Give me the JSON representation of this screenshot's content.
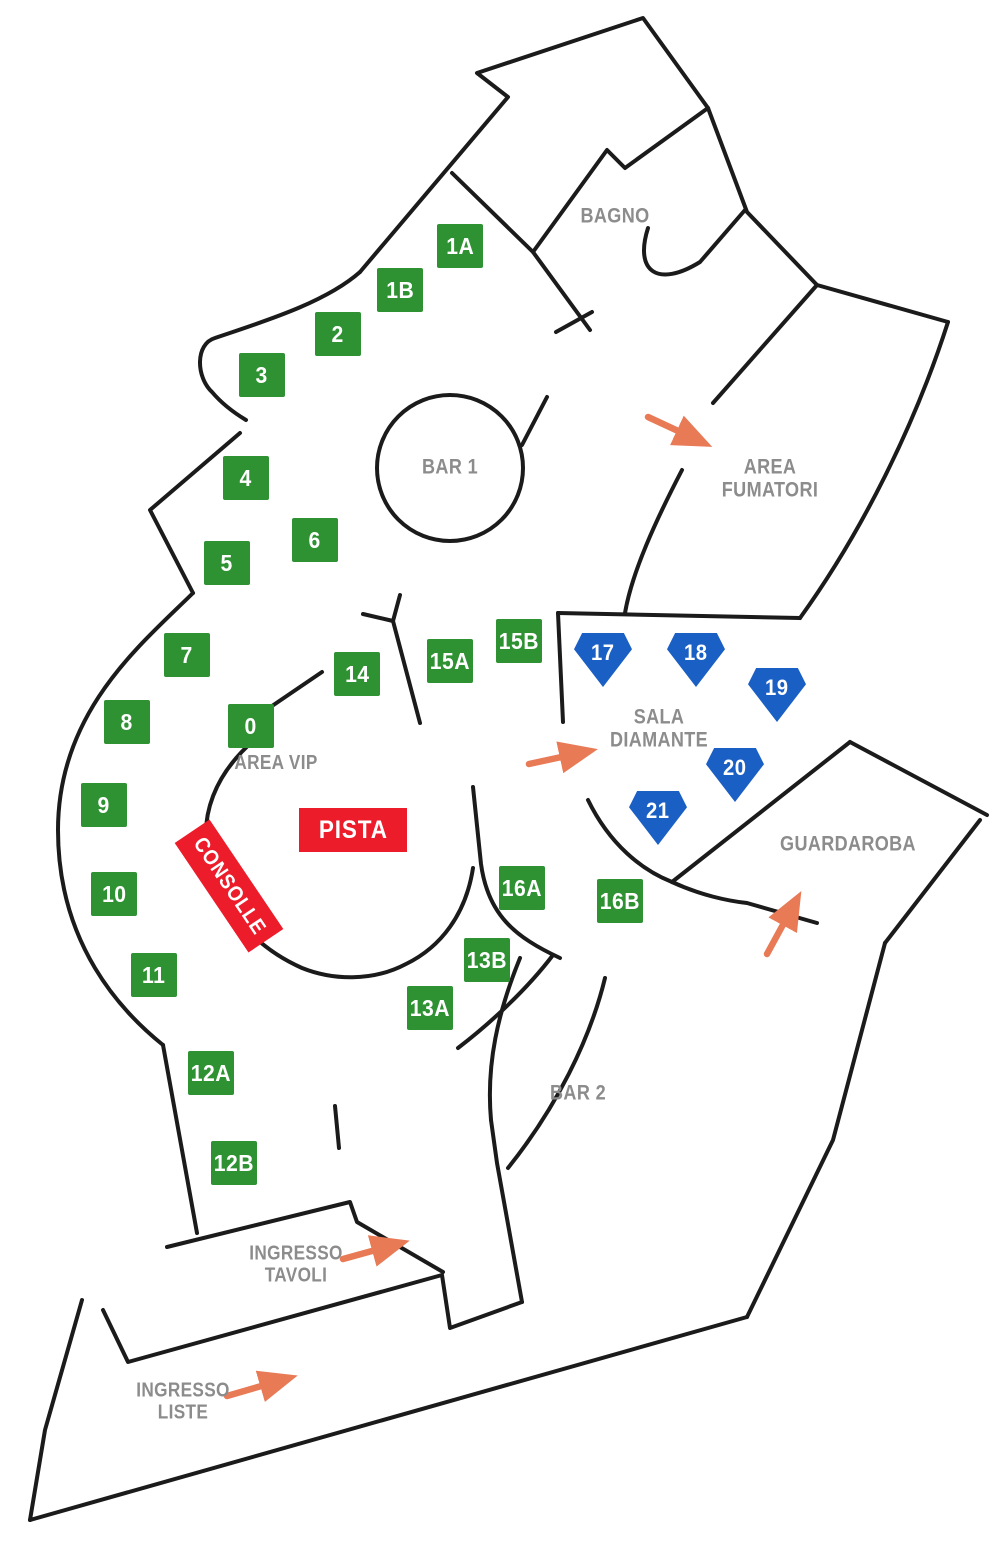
{
  "colors": {
    "wall": "#1b1b1b",
    "table_green": "#2e9132",
    "diamond_blue": "#1a5fc4",
    "accent_red": "#ed1c2b",
    "arrow_orange": "#e87a56",
    "label_gray": "#8c8c8c",
    "marker_text": "#ffffff",
    "background": "#ffffff"
  },
  "rooms": [
    {
      "id": "bagno",
      "label": "BAGNO",
      "x": 615,
      "y": 217,
      "size": 21
    },
    {
      "id": "bar-1",
      "label": "BAR 1",
      "x": 450,
      "y": 468,
      "size": 21
    },
    {
      "id": "area-fumatori",
      "label": "AREA\nFUMATORI",
      "x": 770,
      "y": 479,
      "size": 21
    },
    {
      "id": "sala-diamante",
      "label": "SALA\nDIAMANTE",
      "x": 659,
      "y": 729,
      "size": 21
    },
    {
      "id": "area-vip",
      "label": "AREA VIP",
      "x": 276,
      "y": 764,
      "size": 20
    },
    {
      "id": "guardaroba",
      "label": "GUARDAROBA",
      "x": 848,
      "y": 845,
      "size": 21
    },
    {
      "id": "bar-2",
      "label": "BAR 2",
      "x": 578,
      "y": 1094,
      "size": 21
    },
    {
      "id": "ingresso-tavoli",
      "label": "INGRESSO\nTAVOLI",
      "x": 296,
      "y": 1265,
      "size": 20
    },
    {
      "id": "ingresso-liste",
      "label": "INGRESSO\nLISTE",
      "x": 183,
      "y": 1402,
      "size": 20
    }
  ],
  "tables": {
    "green": [
      {
        "label": "1A",
        "x": 460,
        "y": 246
      },
      {
        "label": "1B",
        "x": 400,
        "y": 290
      },
      {
        "label": "2",
        "x": 338,
        "y": 334
      },
      {
        "label": "3",
        "x": 262,
        "y": 375
      },
      {
        "label": "4",
        "x": 246,
        "y": 478
      },
      {
        "label": "5",
        "x": 227,
        "y": 563
      },
      {
        "label": "6",
        "x": 315,
        "y": 540
      },
      {
        "label": "7",
        "x": 187,
        "y": 655
      },
      {
        "label": "8",
        "x": 127,
        "y": 722
      },
      {
        "label": "9",
        "x": 104,
        "y": 805
      },
      {
        "label": "10",
        "x": 114,
        "y": 894
      },
      {
        "label": "11",
        "x": 154,
        "y": 975
      },
      {
        "label": "12A",
        "x": 211,
        "y": 1073
      },
      {
        "label": "12B",
        "x": 234,
        "y": 1163
      },
      {
        "label": "0",
        "x": 251,
        "y": 726
      },
      {
        "label": "14",
        "x": 357,
        "y": 674
      },
      {
        "label": "15A",
        "x": 450,
        "y": 661
      },
      {
        "label": "15B",
        "x": 519,
        "y": 641
      },
      {
        "label": "13A",
        "x": 430,
        "y": 1008
      },
      {
        "label": "13B",
        "x": 487,
        "y": 960
      },
      {
        "label": "16A",
        "x": 522,
        "y": 888
      },
      {
        "label": "16B",
        "x": 620,
        "y": 901
      }
    ],
    "diamond": [
      {
        "label": "17",
        "x": 603,
        "y": 660
      },
      {
        "label": "18",
        "x": 696,
        "y": 660
      },
      {
        "label": "19",
        "x": 777,
        "y": 695
      },
      {
        "label": "20",
        "x": 735,
        "y": 775
      },
      {
        "label": "21",
        "x": 658,
        "y": 818
      }
    ]
  },
  "pista": {
    "label": "PISTA",
    "x": 299,
    "y": 808,
    "w": 108,
    "h": 44
  },
  "consolle": {
    "label": "CONSOLLE",
    "x": 229,
    "y": 886,
    "w": 132,
    "h": 42,
    "rotation": 56
  },
  "arrows": [
    {
      "name": "arrow-area-fumatori",
      "x1": 648,
      "y1": 417,
      "x2": 704,
      "y2": 443
    },
    {
      "name": "arrow-sala-diamante",
      "x1": 529,
      "y1": 764,
      "x2": 589,
      "y2": 751
    },
    {
      "name": "arrow-guardaroba",
      "x1": 767,
      "y1": 954,
      "x2": 797,
      "y2": 899
    },
    {
      "name": "arrow-ingresso-tavoli",
      "x1": 343,
      "y1": 1259,
      "x2": 401,
      "y2": 1243
    },
    {
      "name": "arrow-ingresso-liste",
      "x1": 227,
      "y1": 1396,
      "x2": 289,
      "y2": 1378
    }
  ]
}
